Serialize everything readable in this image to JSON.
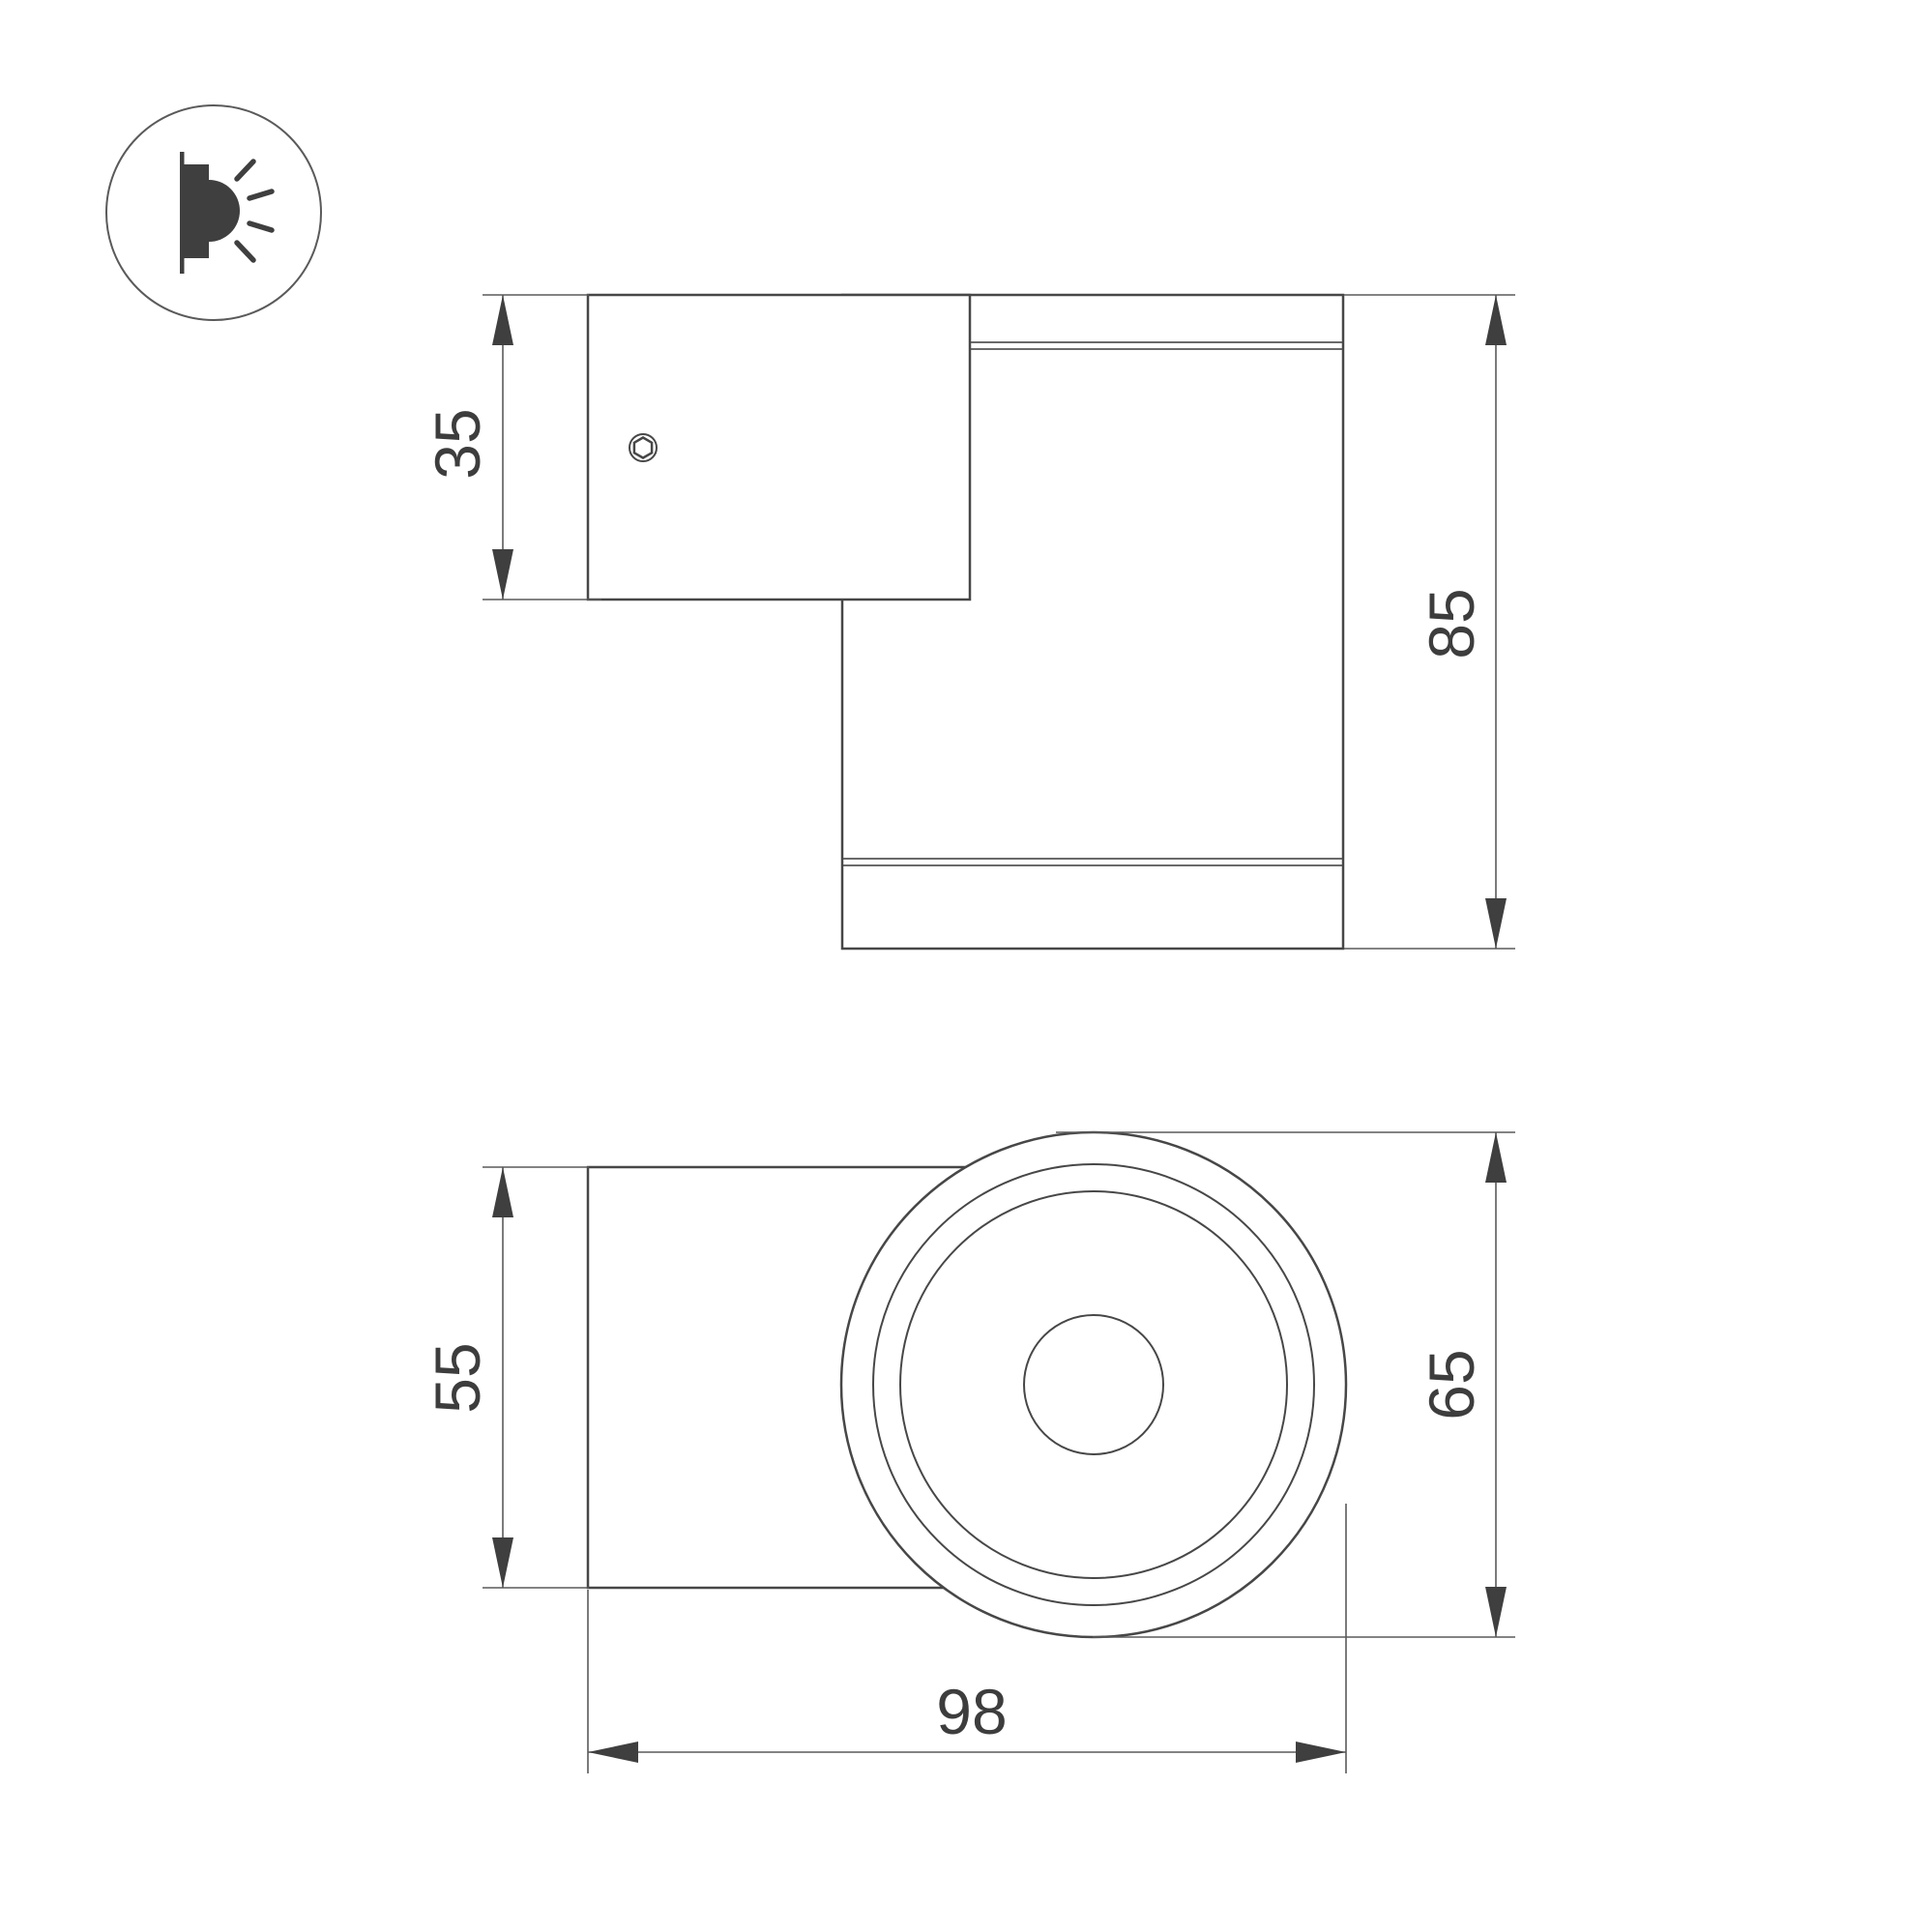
{
  "page": {
    "background": "#ffffff",
    "kind": "technical dimension drawing of a wall-mounted cylindrical luminaire"
  },
  "colors": {
    "outline": "#474747",
    "thin_line": "#5a5a5a",
    "dark_fill": "#3f3f3f",
    "text": "#3d3d3d"
  },
  "icon": {
    "name": "wall-light-emission-icon"
  },
  "dimensions": {
    "side_view": {
      "plate_height": "35",
      "total_height": "85"
    },
    "front_view": {
      "mount_width": "55",
      "body_diameter": "65",
      "total_depth": "98"
    }
  }
}
